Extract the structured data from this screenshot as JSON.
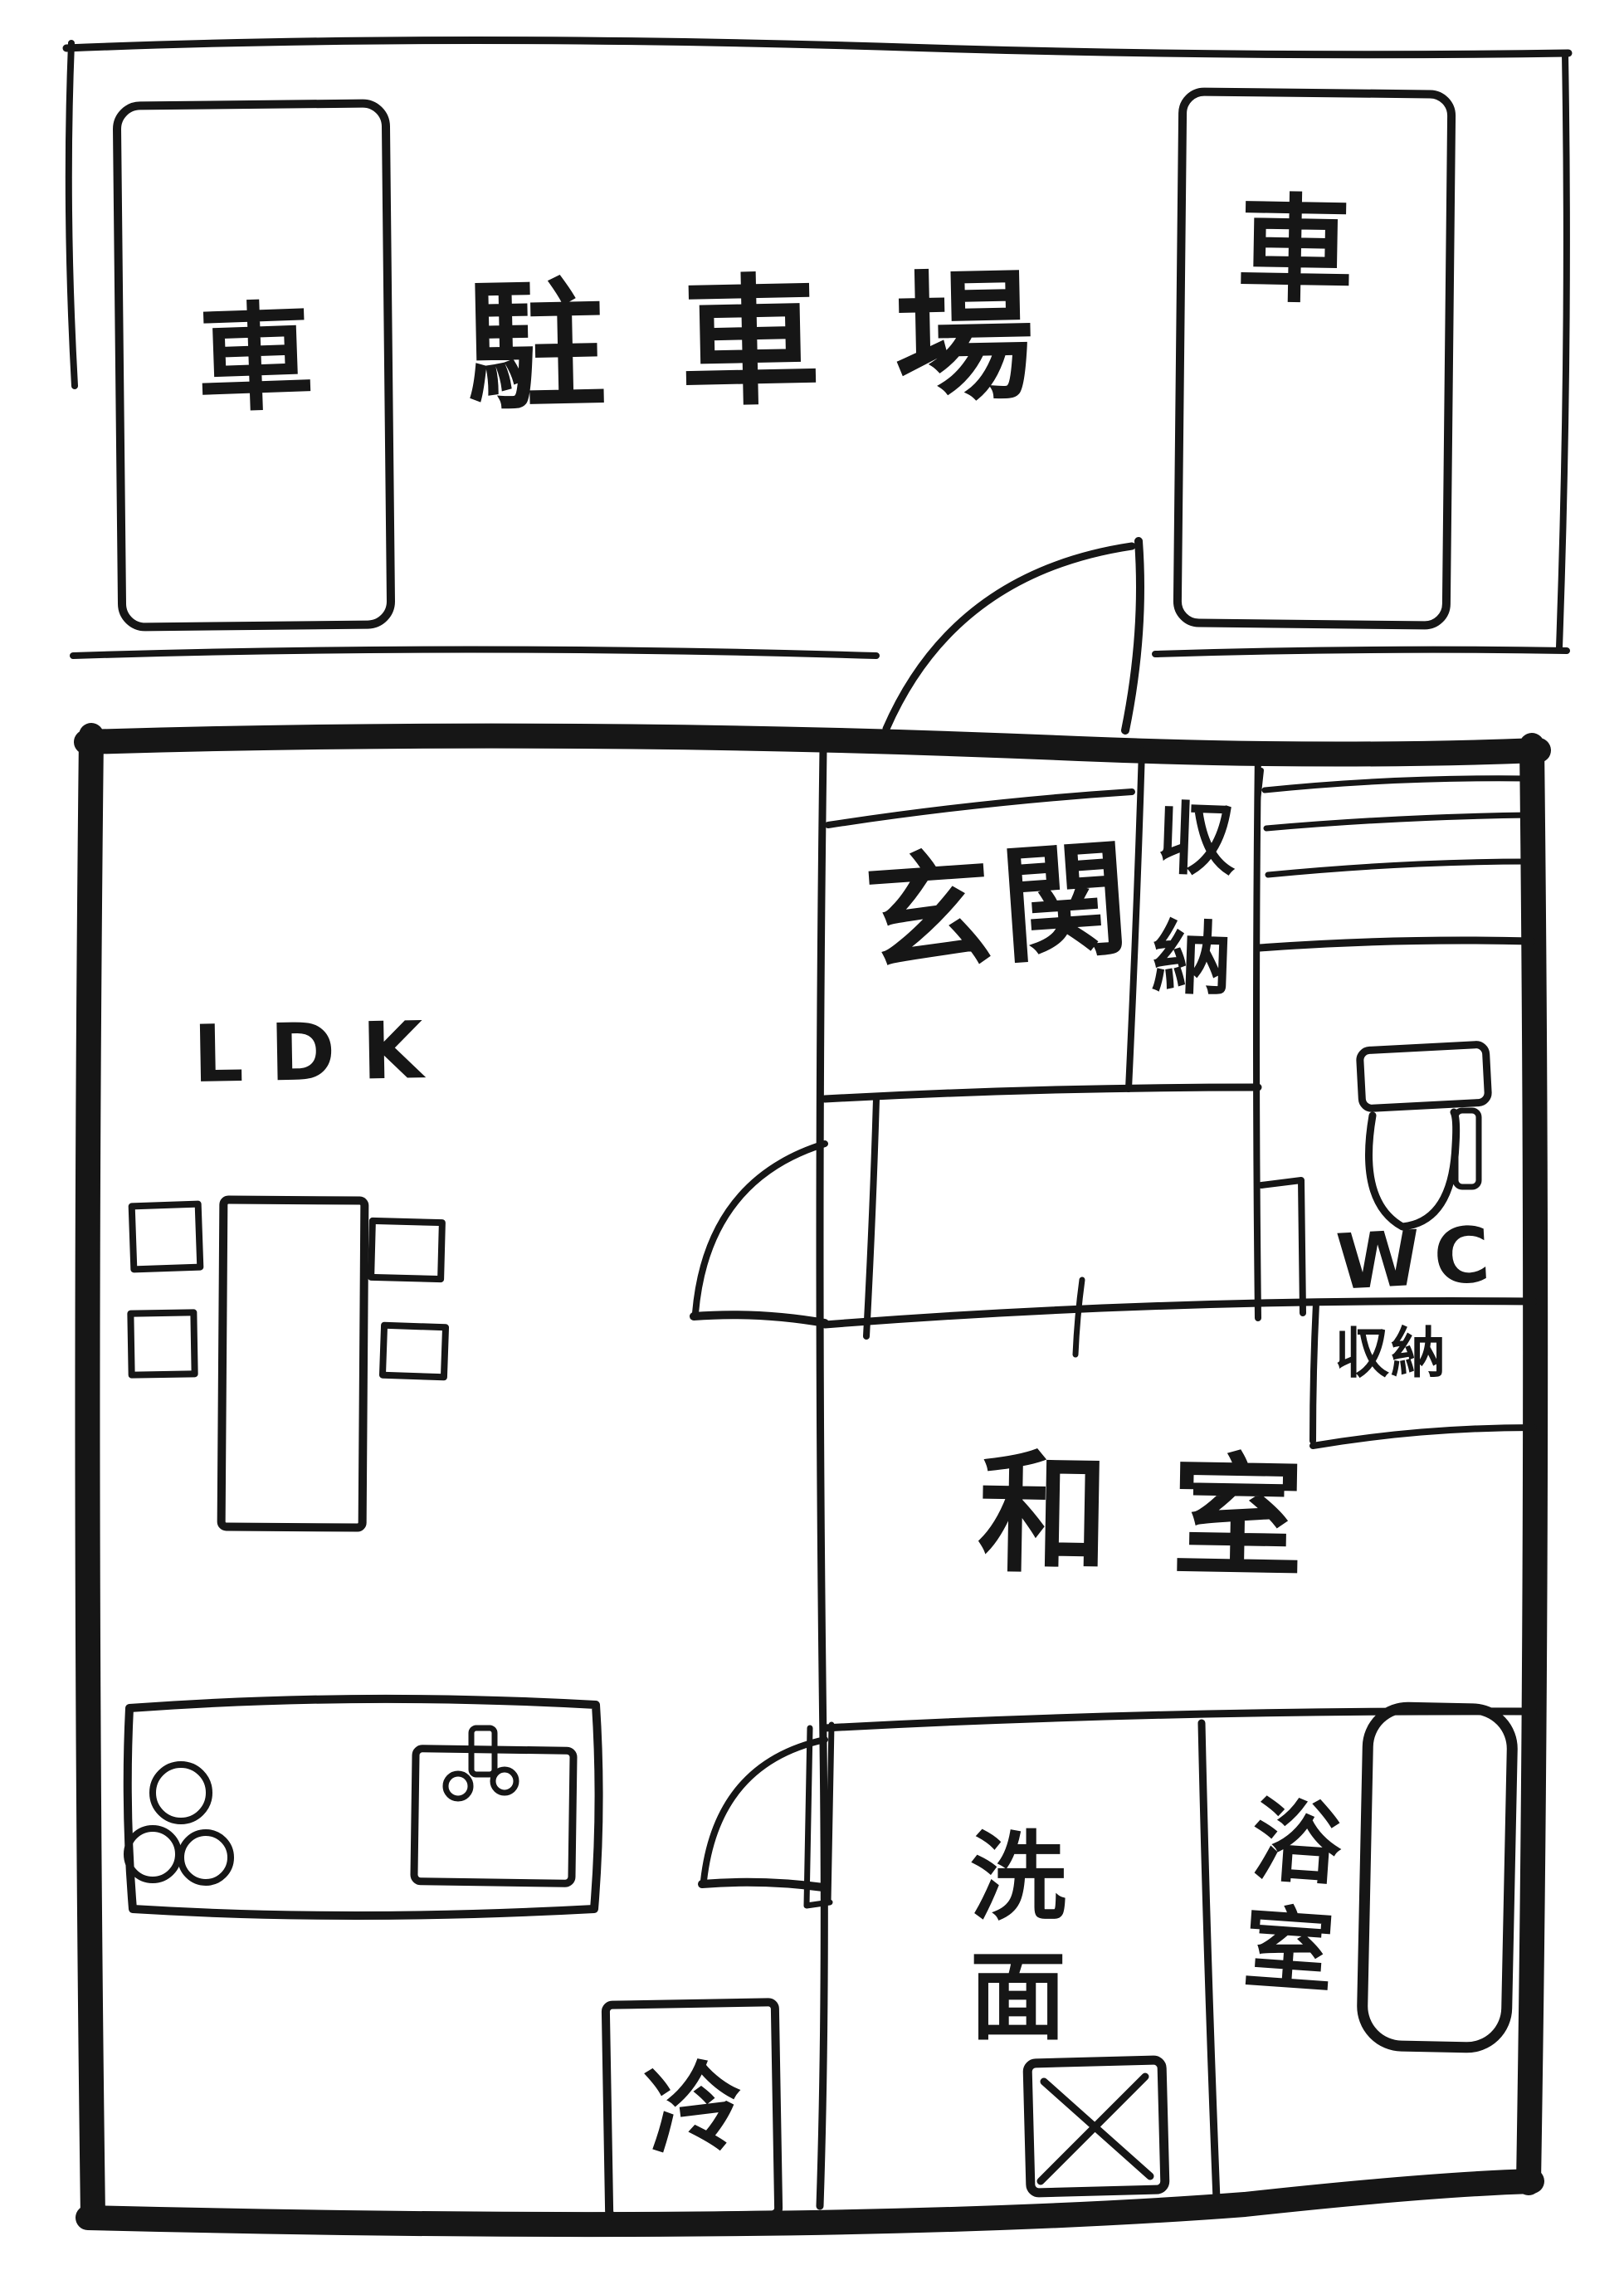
{
  "parking": {
    "area_label": "駐車場",
    "left_stall_label": "車",
    "right_stall_label": "車"
  },
  "rooms": {
    "ldk_label": "LDK",
    "entrance_label": "玄関",
    "entrance_closet_label": "収納",
    "toilet_label": "WC",
    "hall_closet_label": "収納",
    "japanese_room_label": "和室",
    "washroom_label": "洗面",
    "bathroom_label": "浴室",
    "refrigerator_label": "冷"
  },
  "fixtures": {
    "stove_burner_count": 3,
    "chair_count": 4,
    "stair_hatch_line_count": 3,
    "door_swing_count": 3
  },
  "colors": {
    "ink": "#161616",
    "paper": "#ffffff"
  }
}
